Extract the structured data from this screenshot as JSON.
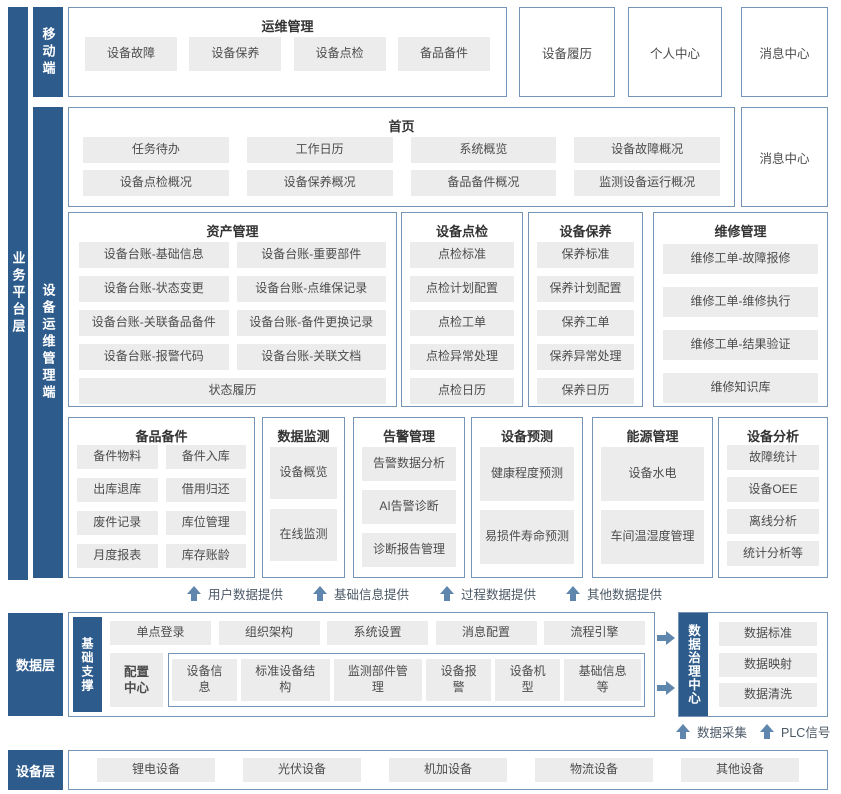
{
  "colors": {
    "primary_blue": "#2d5c8c",
    "box_border": "#7595b6",
    "button_bg": "#ececec",
    "button_text": "#4c4c4c",
    "arrow": "#5f86ad"
  },
  "layers": {
    "business": {
      "label": "业务平台层"
    },
    "mobile": {
      "label": "移动端"
    },
    "device_ops": {
      "label": "设备运维管理端"
    },
    "data": {
      "label": "数据层"
    },
    "device": {
      "label": "设备层"
    }
  },
  "mobile_section": {
    "ops": {
      "title": "运维管理",
      "items": [
        "设备故障",
        "设备保养",
        "设备点检",
        "备品备件"
      ]
    },
    "standalone": [
      "设备履历",
      "个人中心",
      "消息中心"
    ]
  },
  "home": {
    "title": "首页",
    "items": [
      "任务待办",
      "工作日历",
      "系统概览",
      "设备故障概况",
      "设备点检概况",
      "设备保养概况",
      "备品备件概况",
      "监测设备运行概况"
    ],
    "side_box": "消息中心"
  },
  "modules_row1": [
    {
      "title": "资产管理",
      "items": [
        "设备台账-基础信息",
        "设备台账-重要部件",
        "设备台账-状态变更",
        "设备台账-点维保记录",
        "设备台账-关联备品备件",
        "设备台账-备件更换记录",
        "设备台账-报警代码",
        "设备台账-关联文档",
        "状态履历"
      ]
    },
    {
      "title": "设备点检",
      "items": [
        "点检标准",
        "点检计划配置",
        "点检工单",
        "点检异常处理",
        "点检日历"
      ]
    },
    {
      "title": "设备保养",
      "items": [
        "保养标准",
        "保养计划配置",
        "保养工单",
        "保养异常处理",
        "保养日历"
      ]
    },
    {
      "title": "维修管理",
      "items": [
        "维修工单-故障报修",
        "维修工单-维修执行",
        "维修工单-结果验证",
        "维修知识库"
      ]
    }
  ],
  "modules_row2": [
    {
      "title": "备品备件",
      "items": [
        "备件物料",
        "备件入库",
        "出库退库",
        "借用归还",
        "废件记录",
        "库位管理",
        "月度报表",
        "库存账龄"
      ]
    },
    {
      "title": "数据监测",
      "items": [
        "设备概览",
        "在线监测"
      ]
    },
    {
      "title": "告警管理",
      "items": [
        "告警数据分析",
        "AI告警诊断",
        "诊断报告管理"
      ]
    },
    {
      "title": "设备预测",
      "items": [
        "健康程度预测",
        "易损件寿命预测"
      ]
    },
    {
      "title": "能源管理",
      "items": [
        "设备水电",
        "车间温湿度管理"
      ]
    },
    {
      "title": "设备分析",
      "items": [
        "故障统计",
        "设备OEE",
        "离线分析",
        "统计分析等"
      ]
    }
  ],
  "data_flow_labels": [
    "用户数据提供",
    "基础信息提供",
    "过程数据提供",
    "其他数据提供"
  ],
  "base_support": {
    "label": "基础支撑",
    "row1": [
      "单点登录",
      "组织架构",
      "系统设置",
      "消息配置",
      "流程引擎"
    ],
    "config_center": "配置中心",
    "row2": [
      "设备信息",
      "标准设备结构",
      "监测部件管理",
      "设备报警",
      "设备机型",
      "基础信息等"
    ]
  },
  "governance": {
    "label": "数据治理中心",
    "items": [
      "数据标准",
      "数据映射",
      "数据清洗"
    ]
  },
  "collect_labels": [
    "数据采集",
    "PLC信号"
  ],
  "device_layer": {
    "items": [
      "锂电设备",
      "光伏设备",
      "机加设备",
      "物流设备",
      "其他设备"
    ]
  }
}
